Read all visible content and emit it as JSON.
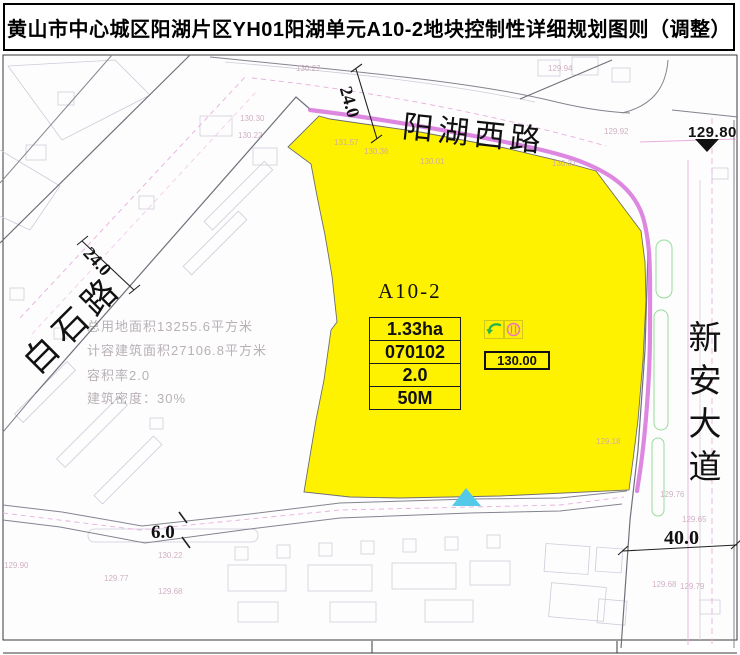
{
  "title": "黄山市中心城区阳湖片区YH01阳湖单元A10-2地块控制性详细规划图则（调整）",
  "roads": {
    "north": "阳湖西路",
    "west": "白石路",
    "east": "新安大道"
  },
  "dims": {
    "north_width": "24.0",
    "west_width": "24.0",
    "south_width": "6.0",
    "east_width": "40.0"
  },
  "parcel": {
    "code": "A10-2",
    "area": "1.33ha",
    "landuse_code": "070102",
    "far": "2.0",
    "height_limit": "50M",
    "elevation": "130.00"
  },
  "benchmark": {
    "value": "129.80"
  },
  "info": {
    "line1": "总用地面积13255.6平方米",
    "line2": "计容建筑面积27106.8平方米",
    "line3": "容积率2.0",
    "line4": "建筑密度：30%"
  },
  "icons": {
    "green_arrow": "curved-entrance-arrow",
    "pink_circle": "circled-gate-symbol",
    "benchmark_triangle": "elevation-benchmark",
    "access_triangle": "parcel-access-marker"
  },
  "colors": {
    "parcel_fill": "#FFF200",
    "boundary_magenta": "#D97ADE",
    "access_cyan": "#55C9E8",
    "arrow_green": "#2AB34A",
    "circle_pink": "#F070C0"
  },
  "spot_elevations": [
    {
      "t": "130.27",
      "x": 296,
      "y": 64
    },
    {
      "t": "129.94",
      "x": 548,
      "y": 64
    },
    {
      "t": "129.92",
      "x": 604,
      "y": 127
    },
    {
      "t": "130.30",
      "x": 240,
      "y": 114
    },
    {
      "t": "130.22",
      "x": 238,
      "y": 131
    },
    {
      "t": "131.57",
      "x": 334,
      "y": 138
    },
    {
      "t": "130.36",
      "x": 364,
      "y": 147
    },
    {
      "t": "130.01",
      "x": 420,
      "y": 157
    },
    {
      "t": "130.31",
      "x": 552,
      "y": 159
    },
    {
      "t": "129.18",
      "x": 596,
      "y": 437
    },
    {
      "t": "129.76",
      "x": 660,
      "y": 490
    },
    {
      "t": "129.65",
      "x": 682,
      "y": 515
    },
    {
      "t": "129.68",
      "x": 652,
      "y": 580
    },
    {
      "t": "129.79",
      "x": 680,
      "y": 582
    },
    {
      "t": "129.90",
      "x": 4,
      "y": 561
    },
    {
      "t": "129.77",
      "x": 104,
      "y": 574
    },
    {
      "t": "130.22",
      "x": 158,
      "y": 551
    },
    {
      "t": "129.68",
      "x": 158,
      "y": 587
    }
  ]
}
